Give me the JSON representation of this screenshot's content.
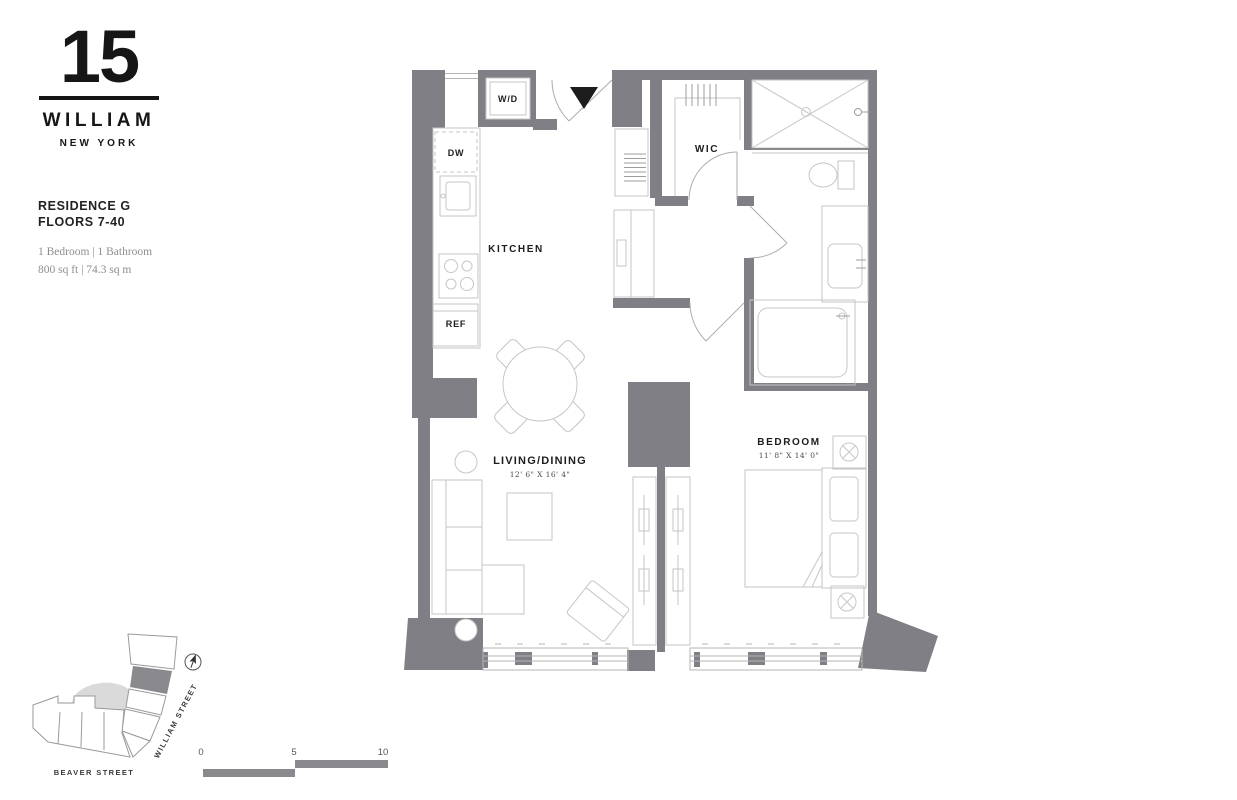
{
  "brand": {
    "number": "15",
    "name": "WILLIAM",
    "city": "NEW YORK"
  },
  "residence": {
    "name": "RESIDENCE G",
    "floors": "FLOORS 7-40",
    "layout": "1 Bedroom | 1 Bathroom",
    "area": "800 sq ft | 74.3 sq m"
  },
  "plan": {
    "rooms": {
      "kitchen": "KITCHEN",
      "wic": "WIC",
      "living_dining": "LIVING/DINING",
      "living_dining_dims": "12' 6\" X 16' 4\"",
      "bedroom": "BEDROOM",
      "bedroom_dims": "11' 8\" X 14' 0\""
    },
    "appliances": {
      "washer_dryer": "W/D",
      "dishwasher": "DW",
      "refrigerator": "REF"
    }
  },
  "site_map": {
    "street_right": "WILLIAM STREET",
    "street_bottom": "BEAVER STREET"
  },
  "scale_bar": {
    "tick_0": "0",
    "tick_5": "5",
    "tick_10": "10"
  },
  "colors": {
    "wall_gray": "#7f7f85",
    "furniture_line": "#c6c6c6",
    "text_dark": "#1d1d1d",
    "text_muted": "#8e8e8e",
    "site_mass": "#dadada",
    "unit_highlight": "#8a8a8e"
  }
}
